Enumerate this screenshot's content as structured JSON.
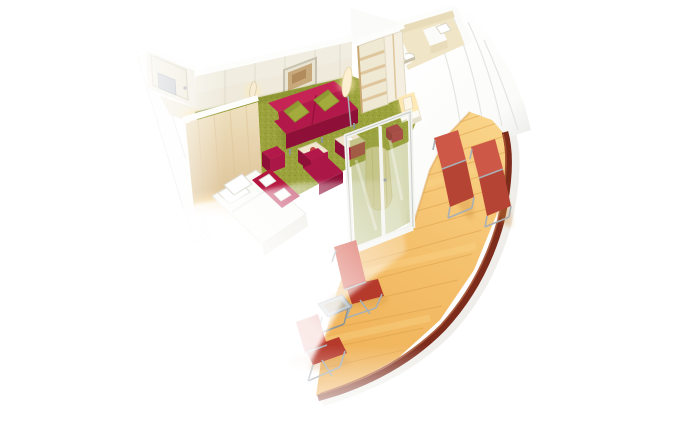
{
  "meta": {
    "description": "Isometric 3D cutaway rendering of a ship suite floor plan with living room, bedroom, bathroom and curved balcony"
  },
  "colors": {
    "background": "#ffffff",
    "wall_cream": "#f1eee1",
    "wall_cream_shade": "#e6e1cd",
    "wall_white": "#fbfbf9",
    "wall_top": "#fdfdfc",
    "wall_line": "#ddd9c7",
    "hull_shade": "#e9e9e6",
    "bath_floor": "#f0e5c6",
    "bath_wall": "#e9dcba",
    "carpet": "#9ca33c",
    "carpet_dark": "#7f872c",
    "carpet_light": "#b6bc62",
    "wood_light": "#eedfbd",
    "wood_mid": "#dfc69c",
    "wood_dark": "#c9a873",
    "art_tan": "#c8a97c",
    "frame_grey": "#c7c2b0",
    "sofa_red": "#b2194a",
    "sofa_red_dark": "#8e1038",
    "sofa_red_light": "#c52455",
    "pillow_green": "#a2ab3c",
    "pillow_green_dark": "#848d2b",
    "ottoman_red": "#ab1747",
    "table_top": "#efe6cd",
    "bed_white": "#fafaf7",
    "bed_shade": "#e9e7dd",
    "runner_red": "#b5163f",
    "towel_white": "#fcfcfa",
    "door_cream": "#ece7d2",
    "safe_grey": "#b7bcc0",
    "glass_green": "#9aa245",
    "curtain_cream": "#f3e9cf",
    "glow_warm": "#ffe9b4",
    "balcony_wood": "#f3bc66",
    "balcony_wood_light": "#f9d489",
    "balcony_plank": "#dc9f49",
    "rail_maroon": "#7d2c1c",
    "rail_maroon_light": "#a3512f",
    "lounger_red": "#cd5848",
    "lounger_red_dark": "#b64434",
    "chair_red": "#d34c3b",
    "chair_red_dark": "#b53a2c",
    "metal": "#a9b0b5",
    "metal_dark": "#8d949a"
  },
  "objects": {
    "rooms": [
      "entrance",
      "living-room",
      "bedroom",
      "bathroom",
      "balcony"
    ],
    "furniture": [
      "entrance-door",
      "wardrobe",
      "bed",
      "sofa",
      "coffee-tables",
      "ottomans",
      "shelving-unit",
      "closet",
      "vanity",
      "curtain",
      "sliding-glass-door",
      "sun-loungers",
      "deck-chairs",
      "deck-table",
      "railing"
    ]
  }
}
